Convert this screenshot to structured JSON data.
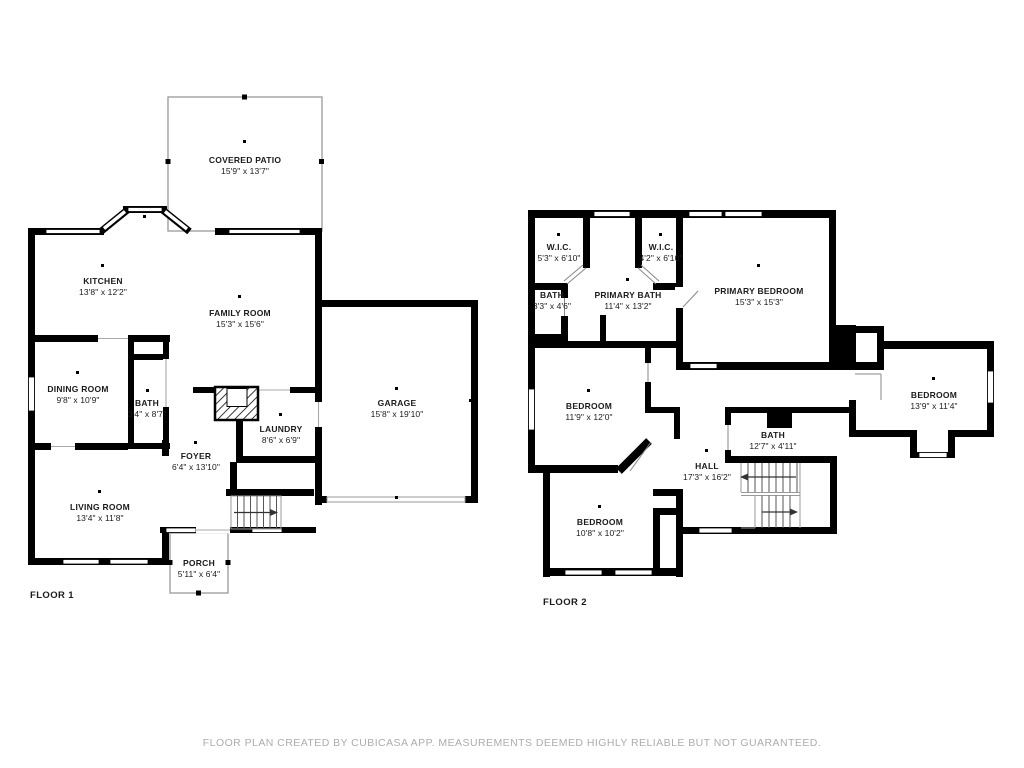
{
  "palette": {
    "wall": "#000000",
    "thin_line": "#999999",
    "label_text": "#1b1b1b",
    "footer_text": "#acacac",
    "background": "#ffffff"
  },
  "footer": {
    "text": "FLOOR PLAN CREATED BY CUBICASA APP. MEASUREMENTS DEEMED HIGHLY RELIABLE BUT NOT GUARANTEED."
  },
  "floor1": {
    "label": "FLOOR 1",
    "rooms": {
      "covered_patio": {
        "name": "COVERED PATIO",
        "dims": "15'9\" x 13'7\""
      },
      "kitchen": {
        "name": "KITCHEN",
        "dims": "13'8\" x 12'2\""
      },
      "family_room": {
        "name": "FAMILY ROOM",
        "dims": "15'3\" x 15'6\""
      },
      "dining_room": {
        "name": "DINING ROOM",
        "dims": "9'8\" x 10'9\""
      },
      "bath": {
        "name": "BATH",
        "dims": "3'4\" x 8'7\""
      },
      "garage": {
        "name": "GARAGE",
        "dims": "15'8\" x 19'10\""
      },
      "laundry": {
        "name": "LAUNDRY",
        "dims": "8'6\" x 6'9\""
      },
      "foyer": {
        "name": "FOYER",
        "dims": "6'4\" x 13'10\""
      },
      "living_room": {
        "name": "LIVING ROOM",
        "dims": "13'4\" x 11'8\""
      },
      "porch": {
        "name": "PORCH",
        "dims": "5'11\" x 6'4\""
      }
    }
  },
  "floor2": {
    "label": "FLOOR 2",
    "rooms": {
      "wic_left": {
        "name": "W.I.C.",
        "dims": "5'3\" x 6'10\""
      },
      "wic_right": {
        "name": "W.I.C.",
        "dims": "4'2\" x 6'10\""
      },
      "bath_small": {
        "name": "BATH",
        "dims": "3'3\" x 4'6\""
      },
      "primary_bath": {
        "name": "PRIMARY BATH",
        "dims": "11'4\" x 13'2\""
      },
      "primary_bedroom": {
        "name": "PRIMARY BEDROOM",
        "dims": "15'3\" x 15'3\""
      },
      "bedroom_left": {
        "name": "BEDROOM",
        "dims": "11'9\" x 12'0\""
      },
      "bedroom_right": {
        "name": "BEDROOM",
        "dims": "13'9\" x 11'4\""
      },
      "bath_hall": {
        "name": "BATH",
        "dims": "12'7\" x 4'11\""
      },
      "hall": {
        "name": "HALL",
        "dims": "17'3\" x 16'2\""
      },
      "bedroom_lower": {
        "name": "BEDROOM",
        "dims": "10'8\" x 10'2\""
      }
    }
  }
}
